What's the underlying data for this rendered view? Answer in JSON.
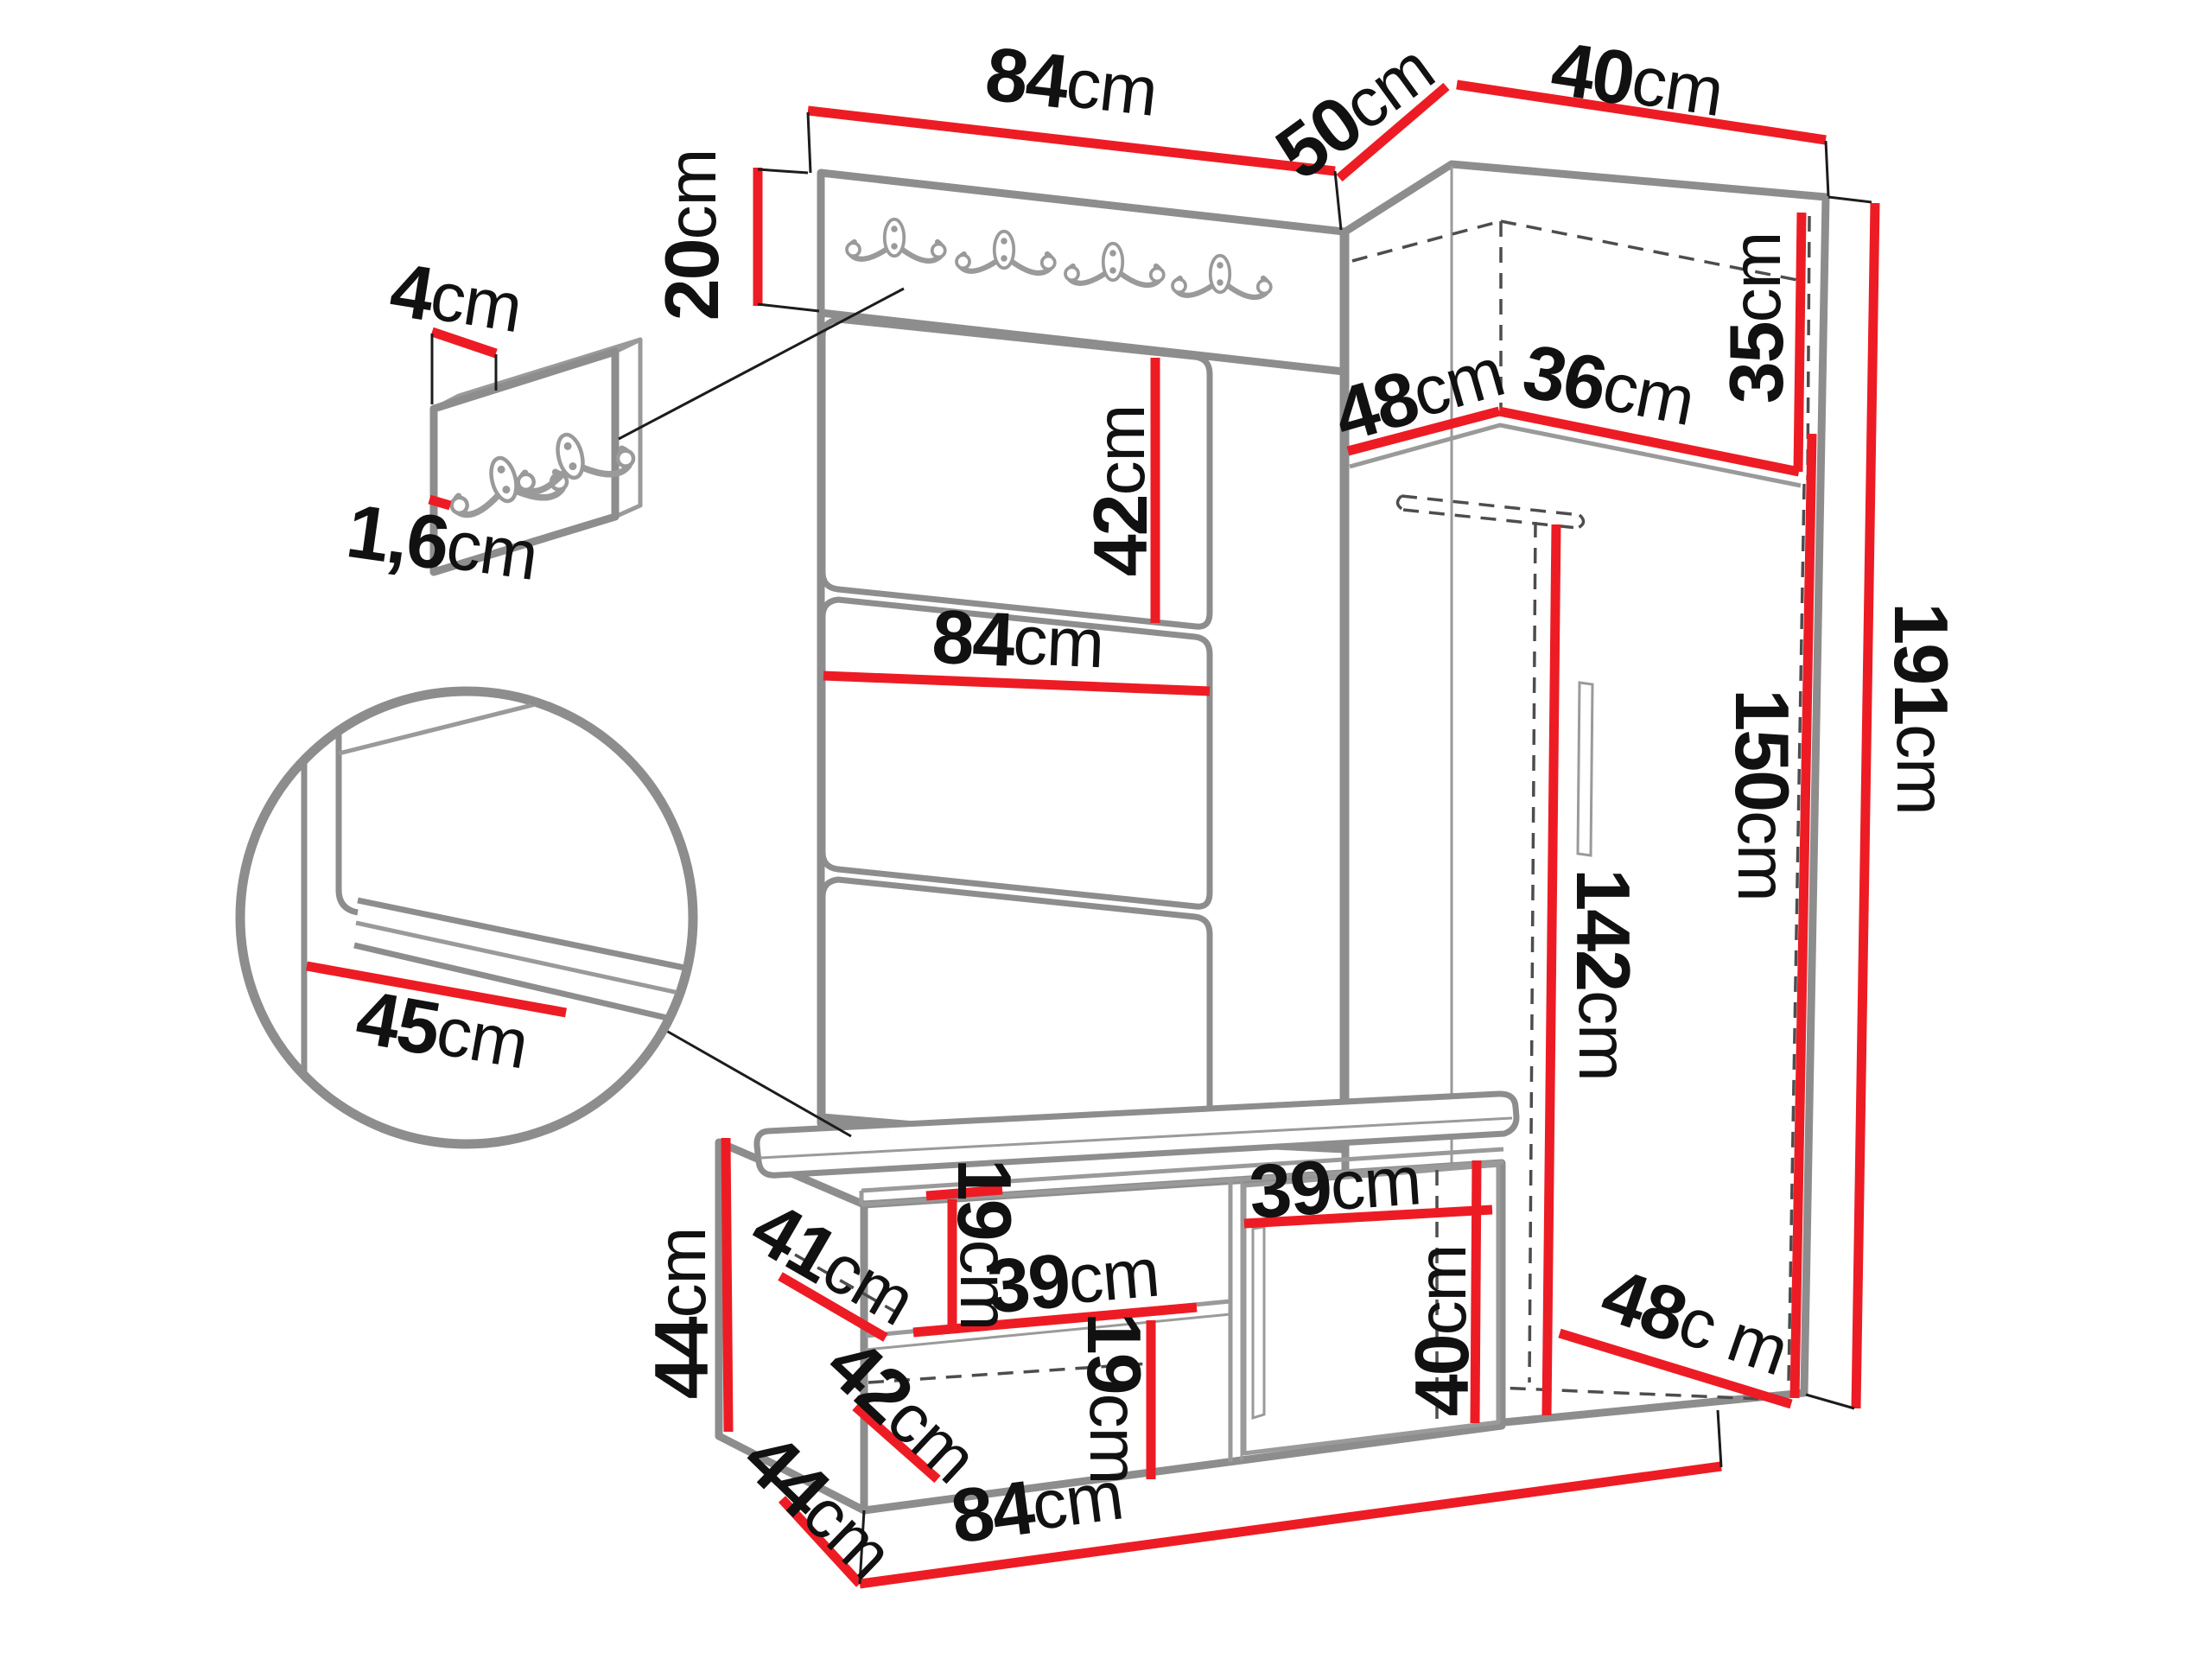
{
  "diagram": {
    "type": "furniture-dimension-drawing",
    "subject": "hallway set: wall panel with hooks, corner wardrobe and shoe bench",
    "unit": "cm",
    "colors": {
      "dimension_line": "#ed1c24",
      "furniture_edge": "#8d8d8d",
      "text": "#111111",
      "background": "#ffffff"
    }
  },
  "labels": {
    "top_panel_width": {
      "num": "84",
      "unit": "cm"
    },
    "hook_board_height": {
      "num": "20",
      "unit": "cm"
    },
    "corner_left_top_width": {
      "num": "50",
      "unit": "cm"
    },
    "corner_right_top_width": {
      "num": "40",
      "unit": "cm"
    },
    "mini_panel_hook_offset": {
      "num": "4",
      "unit": "cm"
    },
    "mini_panel_thickness": {
      "num": "1,6",
      "unit": "cm"
    },
    "cushion_panel_height": {
      "num": "42",
      "unit": "cm"
    },
    "top_shelf_depth": {
      "num": "48",
      "unit": "cm"
    },
    "top_shelf_width": {
      "num": "36",
      "unit": "cm"
    },
    "top_compartment_height": {
      "num": "35",
      "unit": "cm"
    },
    "mid_panel_width": {
      "num": "84",
      "unit": "cm"
    },
    "total_height": {
      "num": "191",
      "unit": "cm"
    },
    "wardrobe_interior_height": {
      "num": "150",
      "unit": "cm"
    },
    "door_height": {
      "num": "142",
      "unit": "cm"
    },
    "seat_cushion_depth": {
      "num": "45",
      "unit": "cm"
    },
    "bench_height": {
      "num": "44",
      "unit": "cm"
    },
    "bench_top_shelf_depth": {
      "num": "41",
      "unit": "cm"
    },
    "bench_top_compartment": {
      "num": "19",
      "unit": "cm"
    },
    "bench_shelf_width": {
      "num": "39",
      "unit": "cm"
    },
    "bench_bottom_shelf_depth": {
      "num": "42",
      "unit": "cm"
    },
    "bench_bottom_compartment": {
      "num": "19",
      "unit": "cm"
    },
    "bench_door_width": {
      "num": "39",
      "unit": "cm"
    },
    "bench_door_height": {
      "num": "40",
      "unit": "cm"
    },
    "wardrobe_floor_depth": {
      "num": "48",
      "unit": "c m"
    },
    "bench_depth": {
      "num": "44",
      "unit": "cm"
    },
    "bench_width": {
      "num": "84",
      "unit": "cm"
    }
  }
}
